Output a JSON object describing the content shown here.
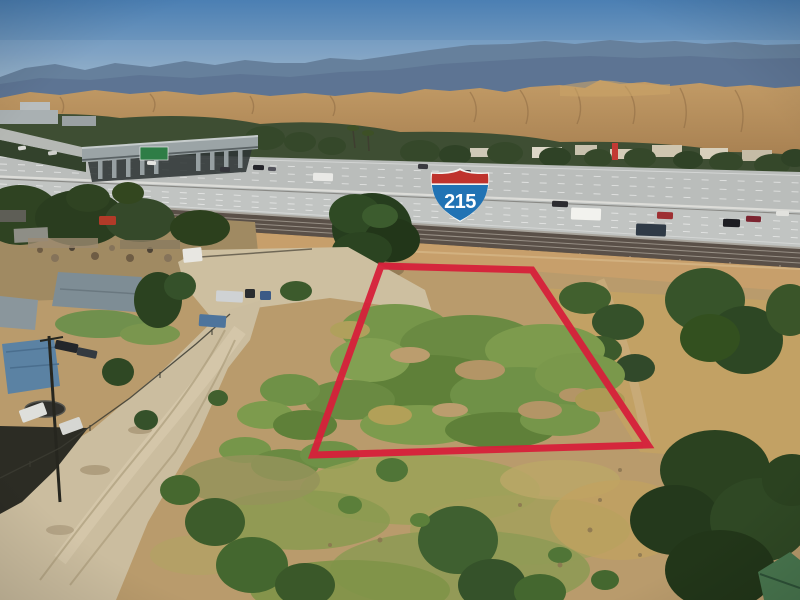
{
  "photo": {
    "alt": "Aerial drone photo of a vacant dirt-and-weed land parcel outlined in red, beside the I-215 freeway and railroad tracks, with homes and a dirt road at left, trees at right, and tan foothills and blue mountains under a clear sky",
    "colors": {
      "sky_top": "#4b7fb3",
      "sky_horizon": "#bccbd5",
      "mountains_far": "#5a7694",
      "mountains_near": "#4e6787",
      "foothills": "#b28b5a",
      "foothill_shadow": "#8a6842",
      "treeline": "#3e4e33",
      "freeway_surface": "#babdbb",
      "railroad": "#5a5048",
      "embankment": "#c79f6b",
      "ground_dirt": "#b99b6c",
      "dirt_road": "#cbbd9f",
      "weeds_green": "#6f9147",
      "dark_trees": "#2b4220",
      "house_roof": "#7e8d95",
      "blue_canopy": "#5b82a3"
    }
  },
  "overlays": {
    "shield": {
      "number": "215",
      "band_color": "#bf332d",
      "body_color": "#2173b4",
      "border_color": "#f4f5f2",
      "text_color": "#ffffff"
    },
    "boundary": {
      "color": "#d6203a",
      "points": "381,266 532,270 648,445 313,455",
      "stroke_width": 7,
      "opacity": 0.95
    }
  },
  "vehicles": [
    {
      "x": 147,
      "y": 161,
      "w": 9,
      "h": 4,
      "c": "#e6e6e2",
      "r": 2
    },
    {
      "x": 220,
      "y": 167,
      "w": 10,
      "h": 5,
      "c": "#35353b",
      "r": 2
    },
    {
      "x": 253,
      "y": 165,
      "w": 11,
      "h": 5,
      "c": "#24242a",
      "r": 2
    },
    {
      "x": 268,
      "y": 167,
      "w": 8,
      "h": 4,
      "c": "#52525a",
      "r": 2
    },
    {
      "x": 313,
      "y": 173,
      "w": 20,
      "h": 8,
      "c": "#e9e9e6",
      "r": 2
    },
    {
      "x": 418,
      "y": 164,
      "w": 10,
      "h": 5,
      "c": "#3a3a40",
      "r": 2
    },
    {
      "x": 460,
      "y": 170,
      "w": 11,
      "h": 5,
      "c": "#2e2e34",
      "r": 2
    },
    {
      "x": 477,
      "y": 173,
      "w": 9,
      "h": 4,
      "c": "#5a5a60",
      "r": 2
    },
    {
      "x": 552,
      "y": 201,
      "w": 16,
      "h": 6,
      "c": "#2c2c30",
      "r": 2
    },
    {
      "x": 571,
      "y": 208,
      "w": 30,
      "h": 12,
      "c": "#f2f2ee",
      "r": 2
    },
    {
      "x": 636,
      "y": 224,
      "w": 30,
      "h": 12,
      "c": "#2f3a46",
      "r": 2
    },
    {
      "x": 657,
      "y": 212,
      "w": 16,
      "h": 7,
      "c": "#9e2f32",
      "r": 2
    },
    {
      "x": 723,
      "y": 219,
      "w": 17,
      "h": 8,
      "c": "#1d1d22",
      "r": 2
    },
    {
      "x": 746,
      "y": 216,
      "w": 15,
      "h": 6,
      "c": "#7c2430",
      "r": 2
    },
    {
      "x": 776,
      "y": 211,
      "w": 13,
      "h": 5,
      "c": "#e2e2de",
      "r": 2
    },
    {
      "x": 18,
      "y": 146,
      "w": 8,
      "h": 4,
      "c": "#d8d8d4",
      "r": -8
    },
    {
      "x": 48,
      "y": 151,
      "w": 9,
      "h": 4,
      "c": "#cfcfcb",
      "r": -8
    },
    {
      "x": 216,
      "y": 291,
      "w": 27,
      "h": 11,
      "c": "#cfd2d4",
      "r": 3
    },
    {
      "x": 245,
      "y": 289,
      "w": 10,
      "h": 9,
      "c": "#2a2d30",
      "r": 0
    },
    {
      "x": 260,
      "y": 291,
      "w": 11,
      "h": 9,
      "c": "#3c5a86",
      "r": 0
    },
    {
      "x": 199,
      "y": 315,
      "w": 27,
      "h": 12,
      "c": "#4d749c",
      "r": 4
    },
    {
      "x": 55,
      "y": 342,
      "w": 23,
      "h": 9,
      "c": "#23262a",
      "r": 12
    },
    {
      "x": 77,
      "y": 349,
      "w": 20,
      "h": 8,
      "c": "#343a40",
      "r": 12
    },
    {
      "x": 99,
      "y": 216,
      "w": 17,
      "h": 9,
      "c": "#b23a28",
      "r": 0
    },
    {
      "x": 183,
      "y": 248,
      "w": 19,
      "h": 14,
      "c": "#e8e7e2",
      "r": -6
    },
    {
      "x": 20,
      "y": 406,
      "w": 26,
      "h": 13,
      "c": "#dedfdb",
      "r": -20
    },
    {
      "x": 60,
      "y": 420,
      "w": 22,
      "h": 12,
      "c": "#d6d7d3",
      "r": -20
    }
  ]
}
